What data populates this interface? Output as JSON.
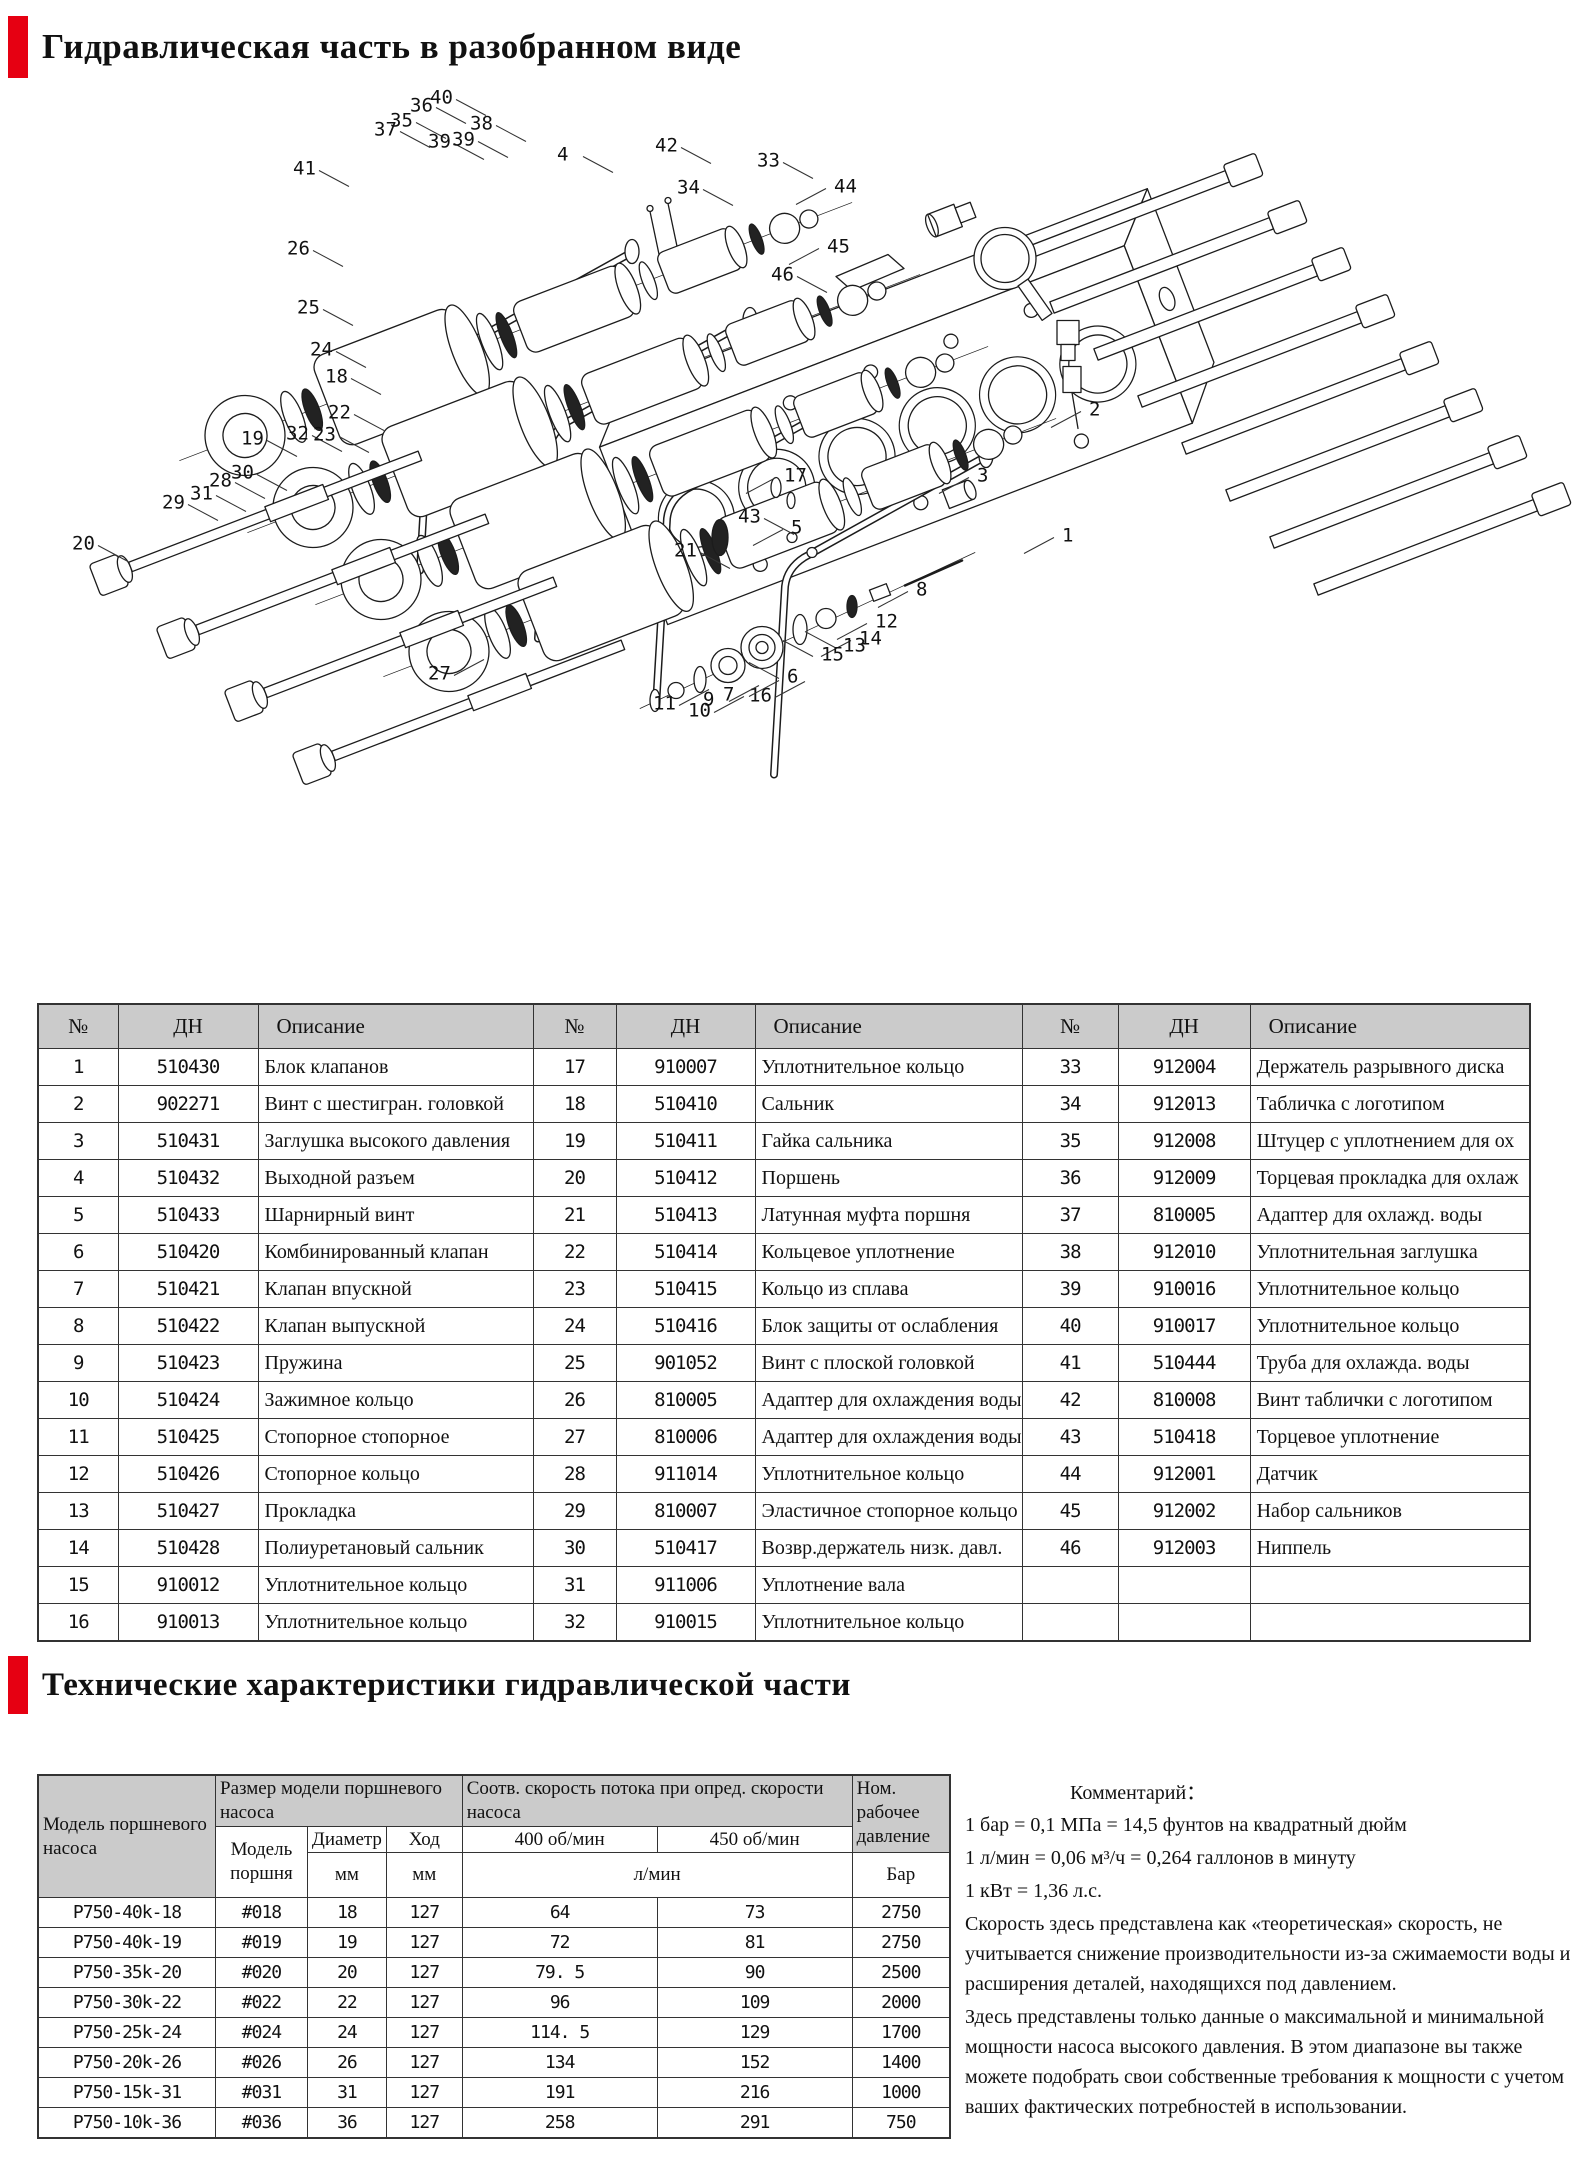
{
  "page": {
    "title1": "Гидравлическая часть в разобранном виде",
    "title2": "Технические характеристики гидравлической части",
    "accent_red": "#e60012",
    "header_gray": "#cbcbcb"
  },
  "parts_table": {
    "headers": [
      "№",
      "ДН",
      "Описание"
    ],
    "group1": [
      {
        "no": "1",
        "dn": "510430",
        "desc": "Блок клапанов"
      },
      {
        "no": "2",
        "dn": "902271",
        "desc": "Винт с шестигран. головкой"
      },
      {
        "no": "3",
        "dn": "510431",
        "desc": "Заглушка высокого давления"
      },
      {
        "no": "4",
        "dn": "510432",
        "desc": "Выходной разъем"
      },
      {
        "no": "5",
        "dn": "510433",
        "desc": "Шарнирный винт"
      },
      {
        "no": "6",
        "dn": "510420",
        "desc": "Комбинированный клапан"
      },
      {
        "no": "7",
        "dn": "510421",
        "desc": "Клапан впускной"
      },
      {
        "no": "8",
        "dn": "510422",
        "desc": "Клапан выпускной"
      },
      {
        "no": "9",
        "dn": "510423",
        "desc": "Пружина"
      },
      {
        "no": "10",
        "dn": "510424",
        "desc": "Зажимное кольцо"
      },
      {
        "no": "11",
        "dn": "510425",
        "desc": "Стопорное стопорное"
      },
      {
        "no": "12",
        "dn": "510426",
        "desc": "Стопорное кольцо"
      },
      {
        "no": "13",
        "dn": "510427",
        "desc": "Прокладка"
      },
      {
        "no": "14",
        "dn": "510428",
        "desc": "Полиуретановый сальник"
      },
      {
        "no": "15",
        "dn": "910012",
        "desc": "Уплотнительное кольцо"
      },
      {
        "no": "16",
        "dn": "910013",
        "desc": "Уплотнительное кольцо"
      }
    ],
    "group2": [
      {
        "no": "17",
        "dn": "910007",
        "desc": "Уплотнительное кольцо"
      },
      {
        "no": "18",
        "dn": "510410",
        "desc": "Сальник"
      },
      {
        "no": "19",
        "dn": "510411",
        "desc": "Гайка сальника"
      },
      {
        "no": "20",
        "dn": "510412",
        "desc": "Поршень"
      },
      {
        "no": "21",
        "dn": "510413",
        "desc": "Латунная муфта поршня"
      },
      {
        "no": "22",
        "dn": "510414",
        "desc": "Кольцевое уплотнение"
      },
      {
        "no": "23",
        "dn": "510415",
        "desc": "Кольцо из сплава"
      },
      {
        "no": "24",
        "dn": "510416",
        "desc": "Блок защиты от ослабления"
      },
      {
        "no": "25",
        "dn": "901052",
        "desc": "Винт с плоской головкой"
      },
      {
        "no": "26",
        "dn": "810005",
        "desc": "Адаптер для охлаждения воды"
      },
      {
        "no": "27",
        "dn": "810006",
        "desc": "Адаптер для охлаждения воды"
      },
      {
        "no": "28",
        "dn": "911014",
        "desc": "Уплотнительное кольцо"
      },
      {
        "no": "29",
        "dn": "810007",
        "desc": "Эластичное стопорное кольцо"
      },
      {
        "no": "30",
        "dn": "510417",
        "desc": "Возвр.держатель низк. давл."
      },
      {
        "no": "31",
        "dn": "911006",
        "desc": "Уплотнение вала"
      },
      {
        "no": "32",
        "dn": "910015",
        "desc": "Уплотнительное кольцо"
      }
    ],
    "group3": [
      {
        "no": "33",
        "dn": "912004",
        "desc": "Держатель разрывного диска"
      },
      {
        "no": "34",
        "dn": "912013",
        "desc": "Табличка с логотипом"
      },
      {
        "no": "35",
        "dn": "912008",
        "desc": "Штуцер с уплотнением для ох"
      },
      {
        "no": "36",
        "dn": "912009",
        "desc": "Торцевая прокладка для охлаж"
      },
      {
        "no": "37",
        "dn": "810005",
        "desc": "Адаптер для охлажд. воды"
      },
      {
        "no": "38",
        "dn": "912010",
        "desc": "Уплотнительная заглушка"
      },
      {
        "no": "39",
        "dn": "910016",
        "desc": "Уплотнительное кольцо"
      },
      {
        "no": "40",
        "dn": "910017",
        "desc": "Уплотнительное кольцо"
      },
      {
        "no": "41",
        "dn": "510444",
        "desc": "Труба для охлажда. воды"
      },
      {
        "no": "42",
        "dn": "810008",
        "desc": "Винт таблички с логотипом"
      },
      {
        "no": "43",
        "dn": "510418",
        "desc": "Торцевое уплотнение"
      },
      {
        "no": "44",
        "dn": "912001",
        "desc": "Датчик"
      },
      {
        "no": "45",
        "dn": "912002",
        "desc": "Набор сальников"
      },
      {
        "no": "46",
        "dn": "912003",
        "desc": "Ниппель"
      },
      {
        "no": "",
        "dn": "",
        "desc": ""
      },
      {
        "no": "",
        "dn": "",
        "desc": ""
      }
    ]
  },
  "spec_table": {
    "col1_header": "Модель поршневого насоса",
    "size_group_header": "Размер модели поршневого насоса",
    "flow_group_header": "Соотв. скорость потока при опред. скорости насоса",
    "pressure_header": "Ном. рабочее давление",
    "sub": {
      "piston_model": "Модель поршня",
      "diameter": "Диаметр",
      "stroke": "Ход",
      "mm1": "мм",
      "mm2": "мм",
      "rpm400": "400  об/мин",
      "rpm450": "450  об/мин",
      "lmin": "л/мин",
      "bar": "Бар"
    },
    "rows": [
      [
        "P750-40k-18",
        "#018",
        "18",
        "127",
        "64",
        "73",
        "2750"
      ],
      [
        "P750-40k-19",
        "#019",
        "19",
        "127",
        "72",
        "81",
        "2750"
      ],
      [
        "P750-35k-20",
        "#020",
        "20",
        "127",
        "79. 5",
        "90",
        "2500"
      ],
      [
        "P750-30k-22",
        "#022",
        "22",
        "127",
        "96",
        "109",
        "2000"
      ],
      [
        "P750-25k-24",
        "#024",
        "24",
        "127",
        "114. 5",
        "129",
        "1700"
      ],
      [
        "P750-20k-26",
        "#026",
        "26",
        "127",
        "134",
        "152",
        "1400"
      ],
      [
        "P750-15k-31",
        "#031",
        "31",
        "127",
        "191",
        "216",
        "1000"
      ],
      [
        "P750-10k-36",
        "#036",
        "36",
        "127",
        "258",
        "291",
        "750"
      ]
    ]
  },
  "comments": {
    "label": "Комментарий：",
    "lines": [
      "1 бар = 0,1 МПа = 14,5 фунтов на квадратный дюйм",
      "1 л/мин = 0,06 м³/ч = 0,264 галлонов в минуту",
      "1 кВт = 1,36 л.с.",
      "Скорость  здесь представлена как «теоретическая» скорость, не учитывается снижение производительности из-за сжимаемости воды и расширения деталей, находящихся под давлением.",
      "Здесь представлены только данные о максимальной и минимальной мощности насоса высокого давления. В этом диапазоне вы также можете подобрать свои собственные требования к мощности с учетом ваших фактических потребностей в использовании."
    ]
  },
  "diagram": {
    "callouts": [
      {
        "n": "36",
        "x": 410,
        "y": 22
      },
      {
        "n": "40",
        "x": 430,
        "y": 14
      },
      {
        "n": "35",
        "x": 390,
        "y": 37
      },
      {
        "n": "37",
        "x": 374,
        "y": 46
      },
      {
        "n": "38",
        "x": 470,
        "y": 40
      },
      {
        "n": "39",
        "x": 428,
        "y": 58
      },
      {
        "n": "39",
        "x": 452,
        "y": 56
      },
      {
        "n": "41",
        "x": 293,
        "y": 85
      },
      {
        "n": "4",
        "x": 557,
        "y": 71
      },
      {
        "n": "42",
        "x": 655,
        "y": 62
      },
      {
        "n": "34",
        "x": 677,
        "y": 104
      },
      {
        "n": "33",
        "x": 757,
        "y": 77
      },
      {
        "n": "44",
        "x": 834,
        "y": 103
      },
      {
        "n": "45",
        "x": 827,
        "y": 163
      },
      {
        "n": "46",
        "x": 771,
        "y": 191
      },
      {
        "n": "26",
        "x": 287,
        "y": 165
      },
      {
        "n": "25",
        "x": 297,
        "y": 224
      },
      {
        "n": "24",
        "x": 310,
        "y": 266
      },
      {
        "n": "18",
        "x": 325,
        "y": 293
      },
      {
        "n": "22",
        "x": 328,
        "y": 329
      },
      {
        "n": "19",
        "x": 241,
        "y": 355
      },
      {
        "n": "32",
        "x": 286,
        "y": 350
      },
      {
        "n": "23",
        "x": 313,
        "y": 351
      },
      {
        "n": "30",
        "x": 231,
        "y": 389
      },
      {
        "n": "28",
        "x": 209,
        "y": 397
      },
      {
        "n": "31",
        "x": 190,
        "y": 410
      },
      {
        "n": "29",
        "x": 162,
        "y": 419
      },
      {
        "n": "20",
        "x": 72,
        "y": 460
      },
      {
        "n": "17",
        "x": 784,
        "y": 392
      },
      {
        "n": "5",
        "x": 791,
        "y": 444
      },
      {
        "n": "1",
        "x": 1062,
        "y": 452
      },
      {
        "n": "2",
        "x": 1089,
        "y": 326
      },
      {
        "n": "3",
        "x": 977,
        "y": 392
      },
      {
        "n": "43",
        "x": 738,
        "y": 433
      },
      {
        "n": "21",
        "x": 674,
        "y": 467
      },
      {
        "n": "8",
        "x": 916,
        "y": 506
      },
      {
        "n": "12",
        "x": 875,
        "y": 538
      },
      {
        "n": "14",
        "x": 859,
        "y": 555
      },
      {
        "n": "13",
        "x": 843,
        "y": 562
      },
      {
        "n": "15",
        "x": 821,
        "y": 571
      },
      {
        "n": "6",
        "x": 787,
        "y": 593
      },
      {
        "n": "27",
        "x": 428,
        "y": 590
      },
      {
        "n": "16",
        "x": 749,
        "y": 612
      },
      {
        "n": "7",
        "x": 723,
        "y": 611
      },
      {
        "n": "9",
        "x": 703,
        "y": 616
      },
      {
        "n": "10",
        "x": 688,
        "y": 627
      },
      {
        "n": "11",
        "x": 653,
        "y": 620
      }
    ]
  }
}
